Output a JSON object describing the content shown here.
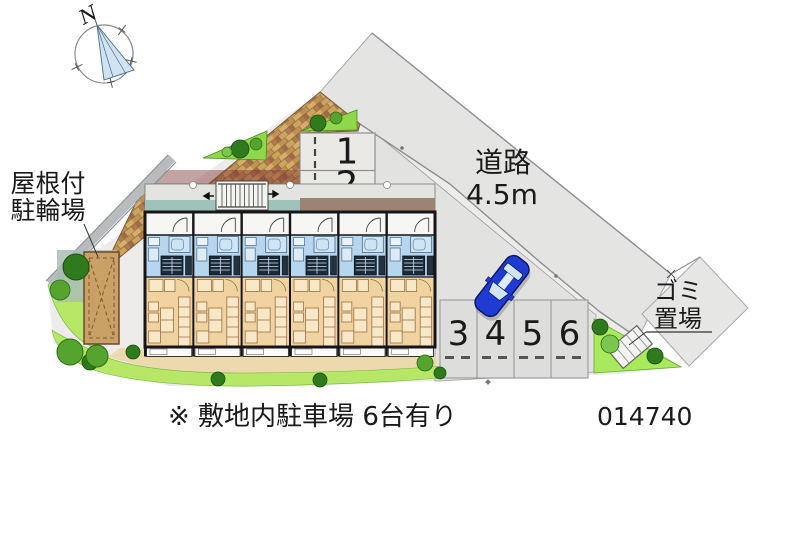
{
  "map": {
    "compass_north": "N",
    "road": {
      "name": "道路",
      "width": "4.5m"
    },
    "covered_bicycle_parking": {
      "line1": "屋根付",
      "line2": "駐輪場"
    },
    "garbage_area": {
      "line1": "ゴミ",
      "line2": "置場"
    },
    "parking_space_labels": [
      "1",
      "2",
      "3",
      "4",
      "5",
      "6"
    ],
    "site_note": "※ 敷地内駐車場 6台有り",
    "plan_number": "014740",
    "building_unit_count": 6,
    "colors": {
      "road_gray": "#e4e4e2",
      "lawn_green": "#b6e766",
      "brick_tan": "#cda45c",
      "room_tan": "#f1d3a1",
      "room_blue": "#b5d6ee",
      "car_blue": "#1f3bd4"
    }
  }
}
